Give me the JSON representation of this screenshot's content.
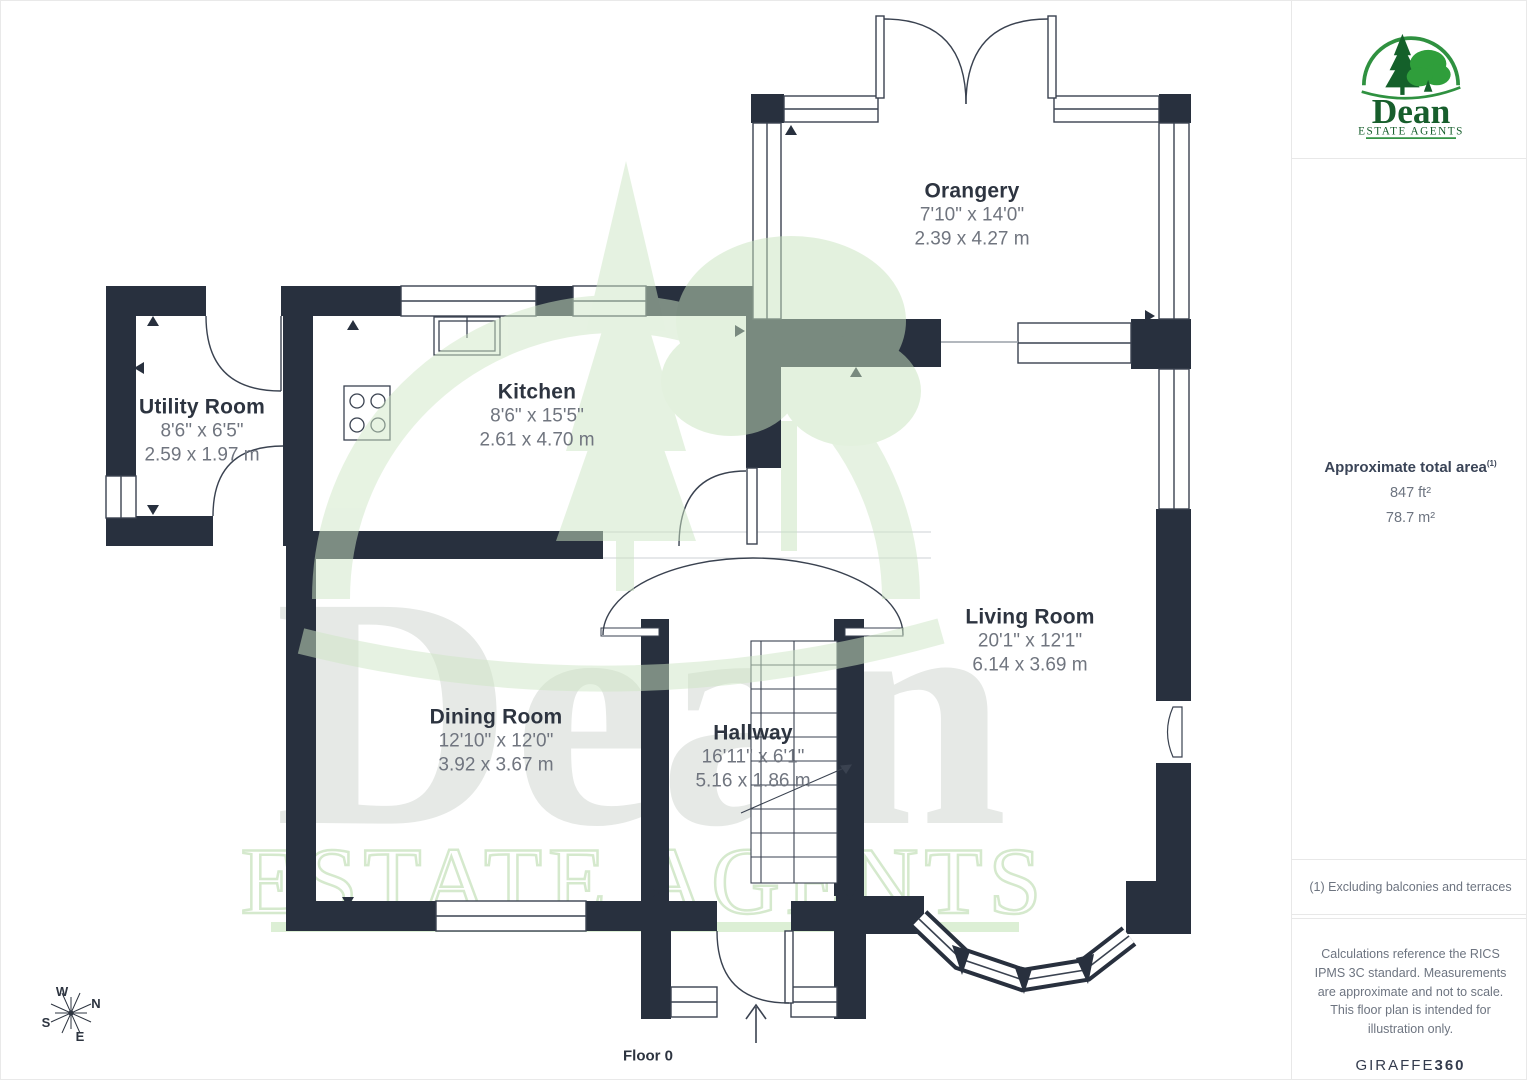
{
  "rooms": [
    {
      "name": "Utility Room",
      "imperial": "8'6\" x 6'5\"",
      "metric": "2.59 x 1.97 m"
    },
    {
      "name": "Kitchen",
      "imperial": "8'6\" x 15'5\"",
      "metric": "2.61 x 4.70 m"
    },
    {
      "name": "Orangery",
      "imperial": "7'10\" x 14'0\"",
      "metric": "2.39 x 4.27 m"
    },
    {
      "name": "Dining Room",
      "imperial": "12'10\" x 12'0\"",
      "metric": "3.92 x 3.67 m"
    },
    {
      "name": "Hallway",
      "imperial": "16'11\" x 6'1\"",
      "metric": "5.16 x 1.86 m"
    },
    {
      "name": "Living Room",
      "imperial": "20'1\" x 12'1\"",
      "metric": "6.14 x 3.69 m"
    }
  ],
  "floor_label": "Floor 0",
  "compass": {
    "n": "N",
    "e": "E",
    "s": "S",
    "w": "W"
  },
  "watermark": {
    "name": "Dean",
    "subtitle": "ESTATE AGENTS"
  },
  "sidebar": {
    "logo": {
      "name": "Dean",
      "subtitle": "ESTATE AGENTS"
    },
    "area": {
      "title": "Approximate total area",
      "footnote_ref": "(1)",
      "imperial": "847 ft²",
      "metric": "78.7 m²"
    },
    "footnote": "(1) Excluding balconies and terraces",
    "disclaimer": "Calculations reference the RICS IPMS 3C standard. Measurements are approximate and not to scale. This floor plan is intended for illustration only.",
    "brand": {
      "text": "GIRAFFE",
      "bold": "360"
    }
  },
  "colors": {
    "wall": "#28303e",
    "line": "#3a4250",
    "accent_green": "#2f9140",
    "watermark_green": "#d7ebd1"
  }
}
